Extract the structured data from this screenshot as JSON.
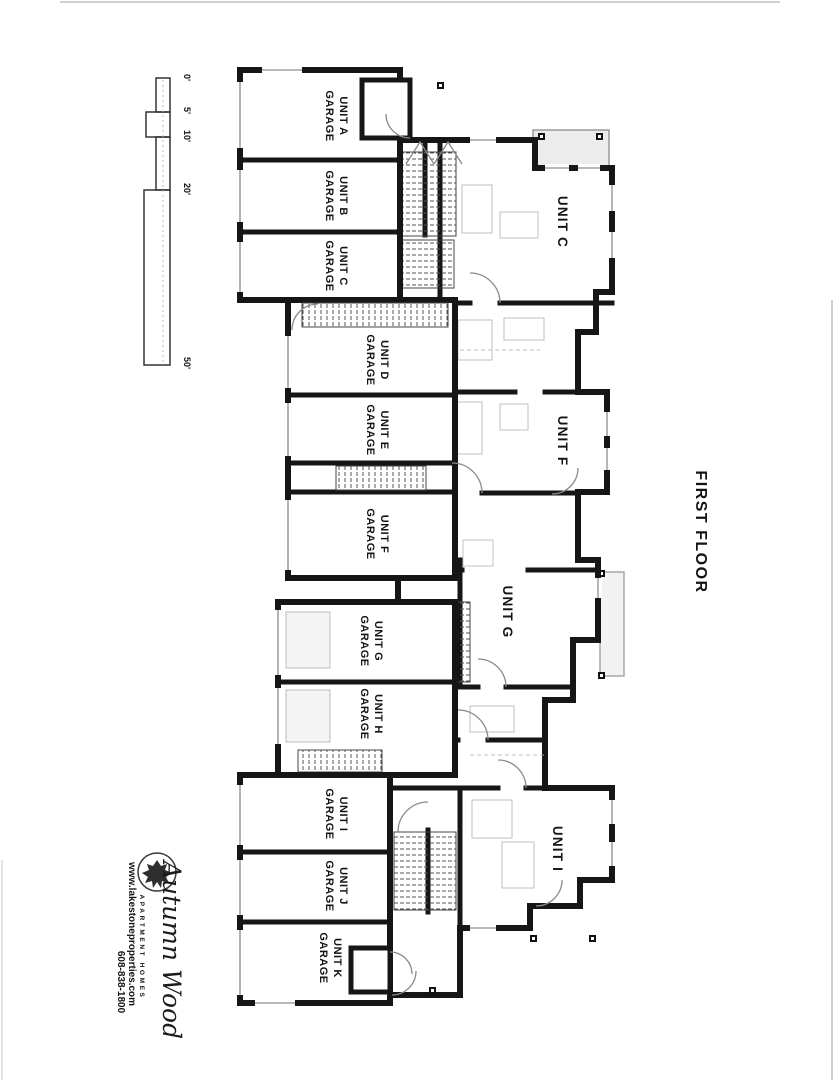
{
  "title": "FIRST FLOOR",
  "scale_bar": {
    "labels": [
      "0'",
      "5'",
      "10'",
      "20'",
      "50'"
    ]
  },
  "garages": [
    {
      "line1": "UNIT A",
      "line2": "GARAGE"
    },
    {
      "line1": "UNIT B",
      "line2": "GARAGE"
    },
    {
      "line1": "UNIT C",
      "line2": "GARAGE"
    },
    {
      "line1": "UNIT D",
      "line2": "GARAGE"
    },
    {
      "line1": "UNIT E",
      "line2": "GARAGE"
    },
    {
      "line1": "UNIT F",
      "line2": "GARAGE"
    },
    {
      "line1": "UNIT G",
      "line2": "GARAGE"
    },
    {
      "line1": "UNIT H",
      "line2": "GARAGE"
    },
    {
      "line1": "UNIT I",
      "line2": "GARAGE"
    },
    {
      "line1": "UNIT J",
      "line2": "GARAGE"
    },
    {
      "line1": "UNIT K",
      "line2": "GARAGE"
    }
  ],
  "units": [
    {
      "label": "UNIT C"
    },
    {
      "label": "UNIT F"
    },
    {
      "label": "UNIT G"
    },
    {
      "label": "UNIT I"
    }
  ],
  "branding": {
    "name": "Autumn Wood",
    "subtitle": "APARTMENT HOMES",
    "website": "www.lakestoneproperties.com",
    "phone": "608-838-1800"
  },
  "colors": {
    "ink": "#161616",
    "deck_fill": "#ececec",
    "deck_stroke": "#9a9a9a",
    "faint": "#b5b5b5"
  }
}
